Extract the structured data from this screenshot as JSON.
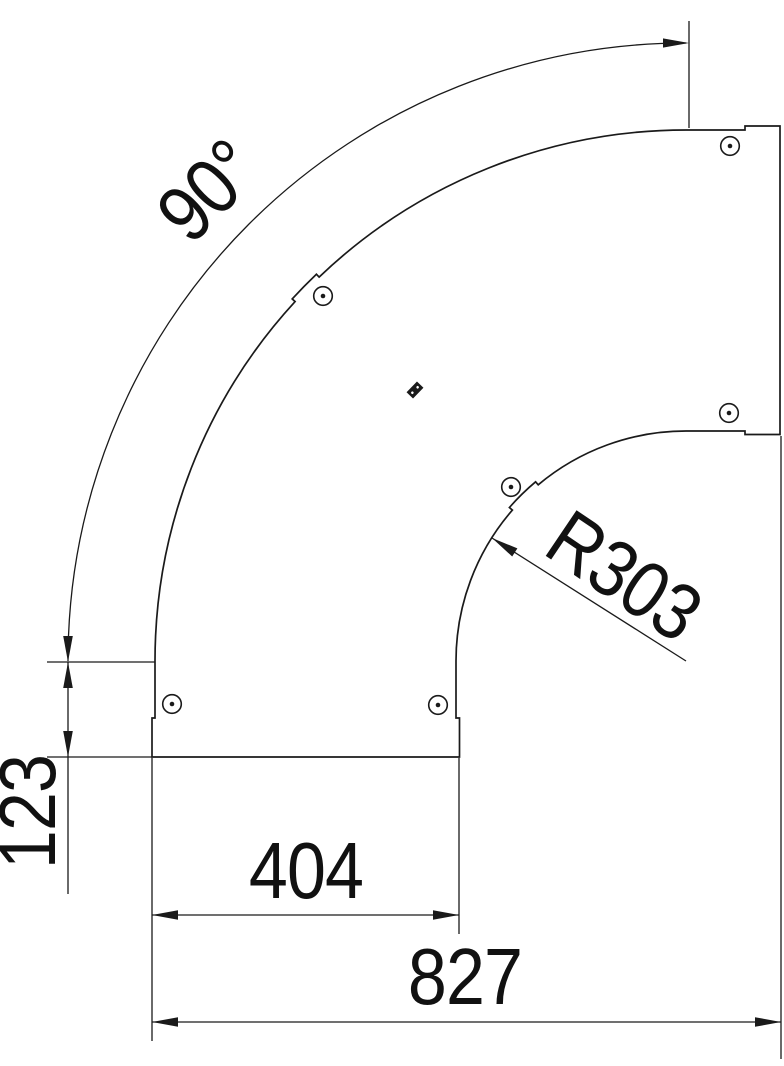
{
  "drawing": {
    "type": "technical-drawing",
    "part": "90-degree-bend-cover",
    "screw_hole_count": 6,
    "colors": {
      "line": "#1a1a1a",
      "text": "#111111",
      "background": "#ffffff"
    },
    "dimensions": {
      "angle": "90°",
      "inner_radius": "R303",
      "leg_length": "123",
      "port_width": "404",
      "overall_length": "827"
    }
  }
}
